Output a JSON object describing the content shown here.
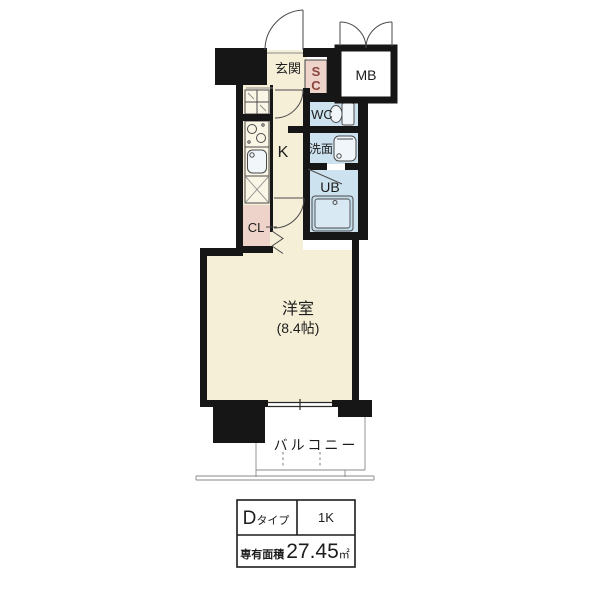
{
  "plan": {
    "labels": {
      "entrance": "玄関",
      "shoe_closet_line1": "S",
      "shoe_closet_line2": "C",
      "meter_box": "MB",
      "toilet": "WC",
      "washroom": "洗面",
      "unit_bath": "UB",
      "kitchen": "K",
      "closet": "CL",
      "main_room": "洋室",
      "main_room_size": "(8.4帖)",
      "balcony": "バルコニー"
    },
    "colors": {
      "wall": "#161616",
      "floor": "#f5efd8",
      "wet": "#cde2ef",
      "accent": "#eed3ca",
      "sc_text": "#8a453c",
      "stroke": "#4a4a4a",
      "thin": "#8a8a8a"
    }
  },
  "spec_table": {
    "type_letter": "D",
    "type_suffix": "タイプ",
    "layout": "1K",
    "area_label": "専有面積",
    "area_value": "27.45",
    "area_unit": "㎡"
  }
}
